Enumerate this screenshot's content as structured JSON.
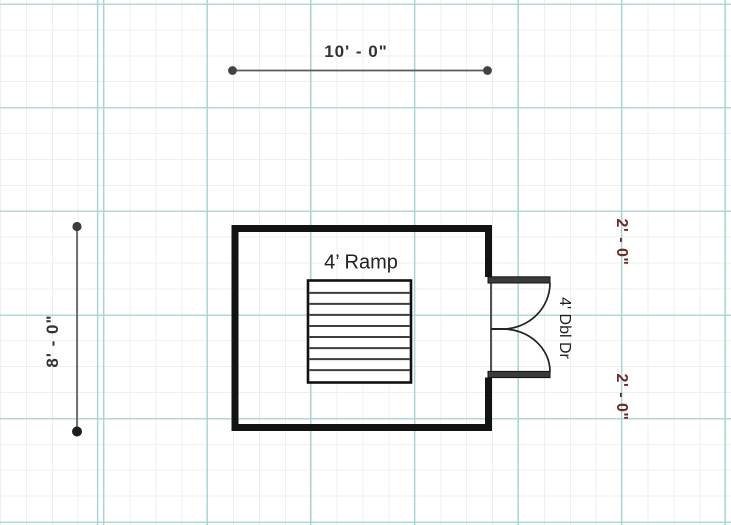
{
  "canvas": {
    "type": "floor-plan-drawing",
    "grid": {
      "major_color": "#a9d5d4",
      "minor_color": "#f0efef",
      "major_spacing_px": 103.6,
      "minor_spacing_px": 25.9
    }
  },
  "colors": {
    "wall": "#131313",
    "dimension_line": "#5a5a5a",
    "dimension_text": "#333333",
    "offset_dimension_text": "#6d2b28",
    "ramp_hatch": "#3d3d3d"
  },
  "dimensions": {
    "top": {
      "label": "10' - 0\""
    },
    "left": {
      "label": "8' - 0\""
    },
    "right_top": {
      "label": "2' - 0\""
    },
    "right_bottom": {
      "label": "2' - 0\""
    }
  },
  "room": {
    "ramp": {
      "label": "4’ Ramp",
      "strip_count": 9
    },
    "door": {
      "label": "4' Dbl Dr"
    }
  }
}
